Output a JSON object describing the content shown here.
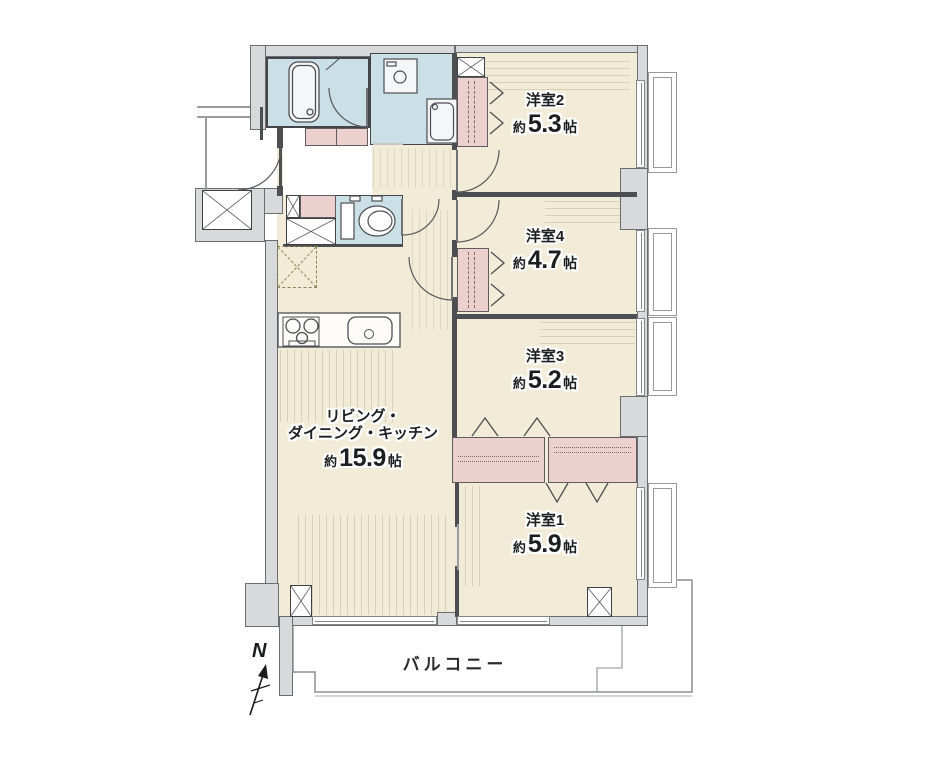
{
  "plan": {
    "compass_label": "N",
    "balcony_label": "バルコニー",
    "rooms": [
      {
        "name": "洋室2",
        "approx": "約",
        "size": "5.3",
        "unit": "帖"
      },
      {
        "name": "洋室4",
        "approx": "約",
        "size": "4.7",
        "unit": "帖"
      },
      {
        "name": "洋室3",
        "approx": "約",
        "size": "5.2",
        "unit": "帖"
      },
      {
        "name": "洋室1",
        "approx": "約",
        "size": "5.9",
        "unit": "帖"
      },
      {
        "name_line1": "リビング・",
        "name_line2": "ダイニング・キッチン",
        "approx": "約",
        "size": "15.9",
        "unit": "帖"
      }
    ],
    "colors": {
      "floor": "#f2ebd7",
      "wet_area": "#cbdfe6",
      "closet": "#ecd0cd",
      "wall_fill": "#d7d9db",
      "outline": "#54565a"
    }
  }
}
